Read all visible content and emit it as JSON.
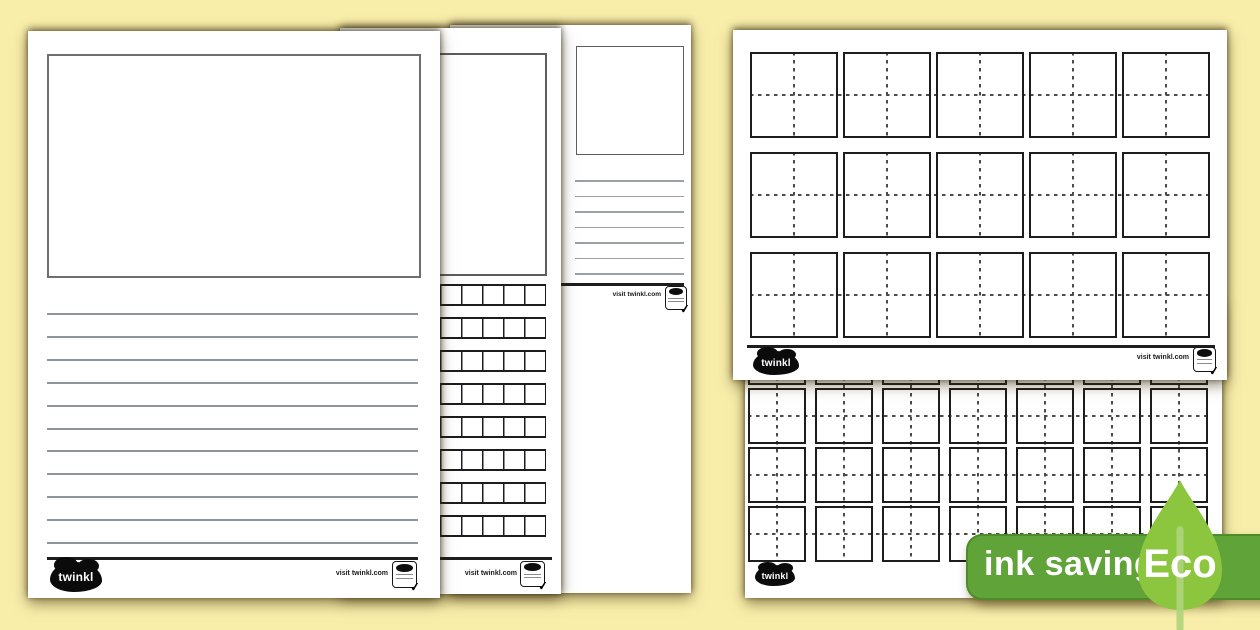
{
  "background": {
    "color": "#F8EDA9"
  },
  "colors": {
    "page": "#FFFFFF",
    "ink": "#1D1D1D",
    "rule_gray": "#8F939B",
    "dash_gray": "#4B4B4B"
  },
  "icons": {
    "check": "✓"
  },
  "branding": {
    "logo_text": "twinkl",
    "visit_text": "visit twinkl.com"
  },
  "eco_badge": {
    "label": "ink saving",
    "eco_label": "Eco",
    "pill_color": "#60A339",
    "pill_border_color": "#4E8C29",
    "leaf_color": "#8CC63F",
    "stem_color": "#AED37A",
    "text_color": "#FFFFFF"
  },
  "pages": {
    "front_left": {
      "name": "picture box with lined writing worksheet",
      "has_picture_box": true,
      "line_count": 11
    },
    "middle_left": {
      "name": "picture box with letter-box rows worksheet",
      "has_picture_box": true,
      "grid_rows": 8
    },
    "back_left": {
      "name": "small picture box with lines worksheet",
      "has_picture_box": true,
      "line_count": 7
    },
    "top_right": {
      "name": "handwriting practice squares (landscape)",
      "columns": 5,
      "rows": 3
    },
    "bottom_right": {
      "name": "handwriting practice squares",
      "columns": 7,
      "rows": 4
    }
  }
}
